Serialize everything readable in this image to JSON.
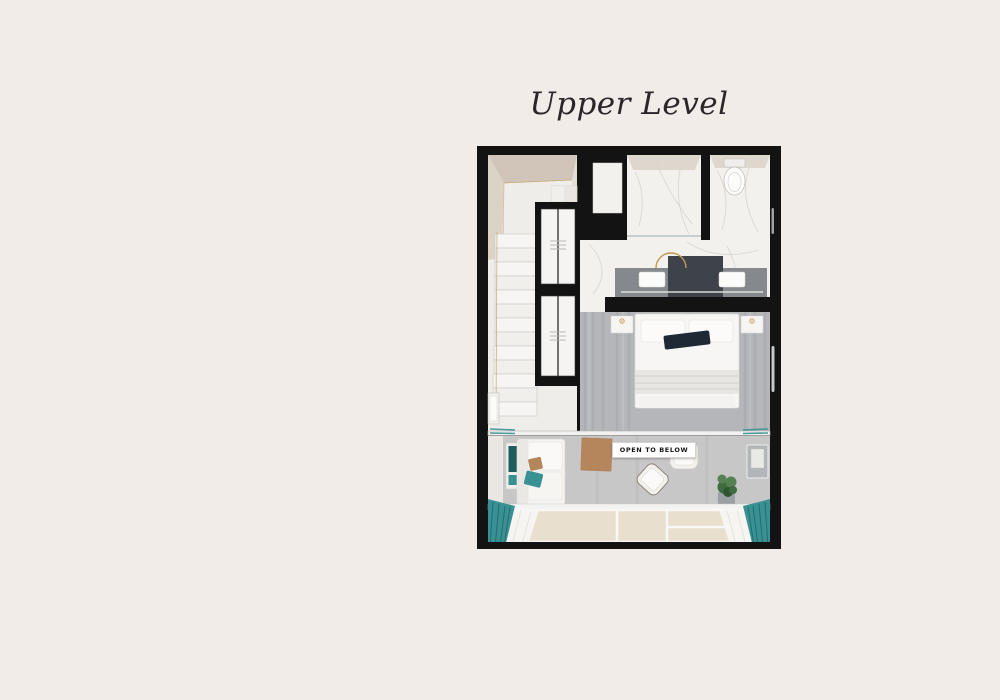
{
  "title": "Upper Level",
  "floorplan": {
    "open_to_below_label": "OPEN TO BELOW",
    "elements": [
      "stair-landing",
      "staircase",
      "wardrobe",
      "shower-room",
      "toilet-room",
      "bathroom-vanity",
      "bedroom",
      "railing",
      "lounge",
      "window-wall"
    ]
  },
  "colors": {
    "page_bg": "#f1ece7",
    "wall": "#131313",
    "title_text": "#2c2529",
    "beige_wall": "#d0c5b8",
    "beige_light": "#dcd3c7",
    "room_floor": "#efede9",
    "step": "#f6f5f3",
    "step_edge": "#cac7c2",
    "marble": "#f3f1ee",
    "marble_vein": "#d6d2cc",
    "floor_bed": "#b5b6b9",
    "floor_streak": "#a0a1a5",
    "floor_lounge": "#c8c7c8",
    "counter": "#85898e",
    "counter_dark": "#3e434a",
    "dark_pillow": "#1f2935",
    "teal": "#3a9193",
    "teal_dark": "#1e5c5e",
    "tan": "#b5855c",
    "gold": "#c09a52",
    "window_pane": "#e9dfcf",
    "plant_green": "#3f6b3e",
    "plant_green_light": "#568155",
    "label_bg": "#ffffff",
    "label_text": "#151515",
    "chrome": "#c6c8c9"
  }
}
